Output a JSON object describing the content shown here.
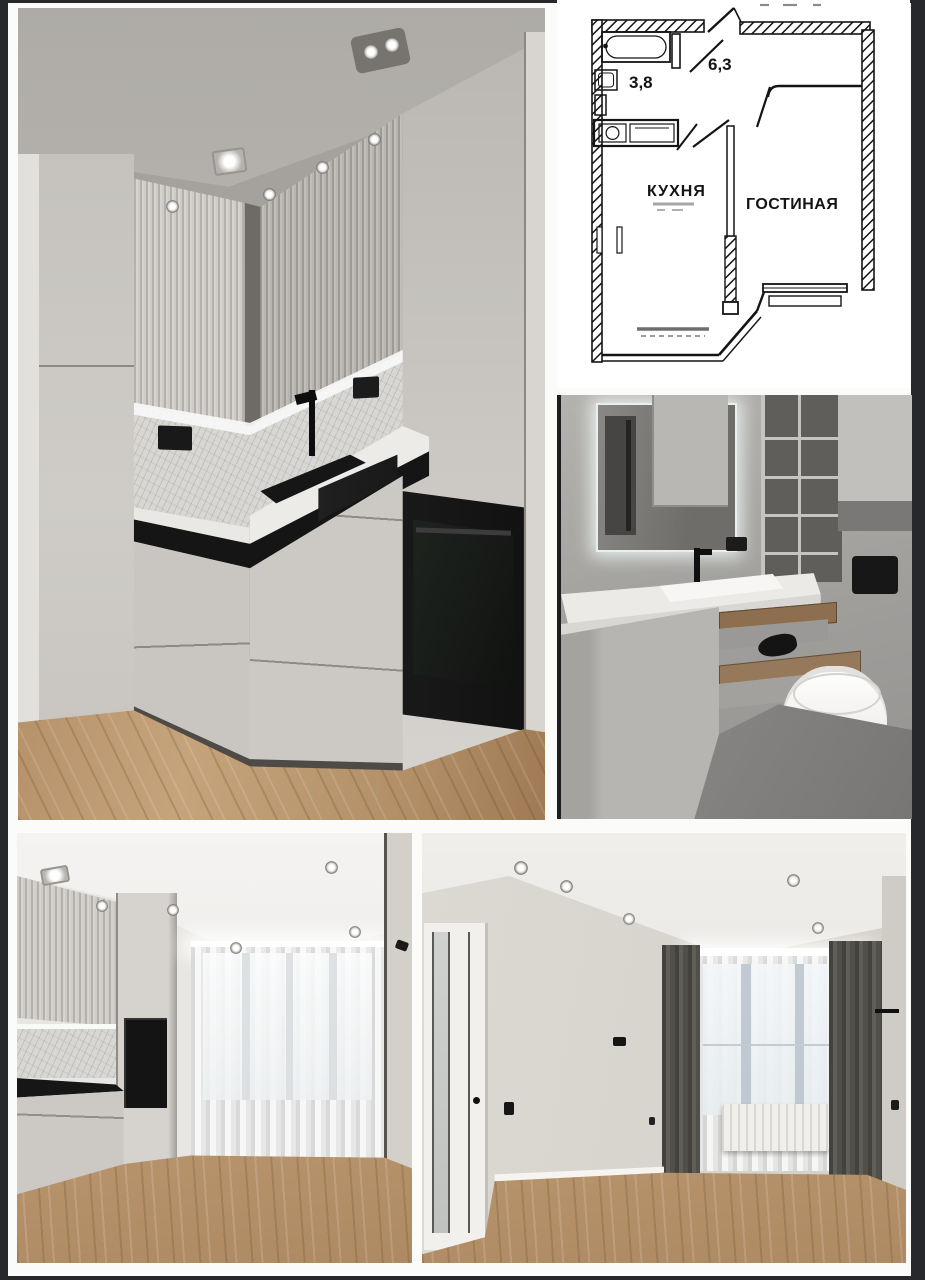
{
  "collage": {
    "background": "#fbfbfa",
    "frame_color": "#27282b"
  },
  "floorplan": {
    "ink": "#141414",
    "labels": {
      "bathroom_area": "3,8",
      "hallway_area": "6,3",
      "kitchen": "КУХНЯ",
      "living_room": "ГОСТИНАЯ"
    }
  },
  "palette": {
    "cabinet_gray": "#c9c6c1",
    "counter_black": "#151515",
    "wood_floor": "#bb9770",
    "tile_gray": "#a5a3a0",
    "curtain_dark": "#514f4a",
    "led_glow_white": "#f7f9f7"
  }
}
